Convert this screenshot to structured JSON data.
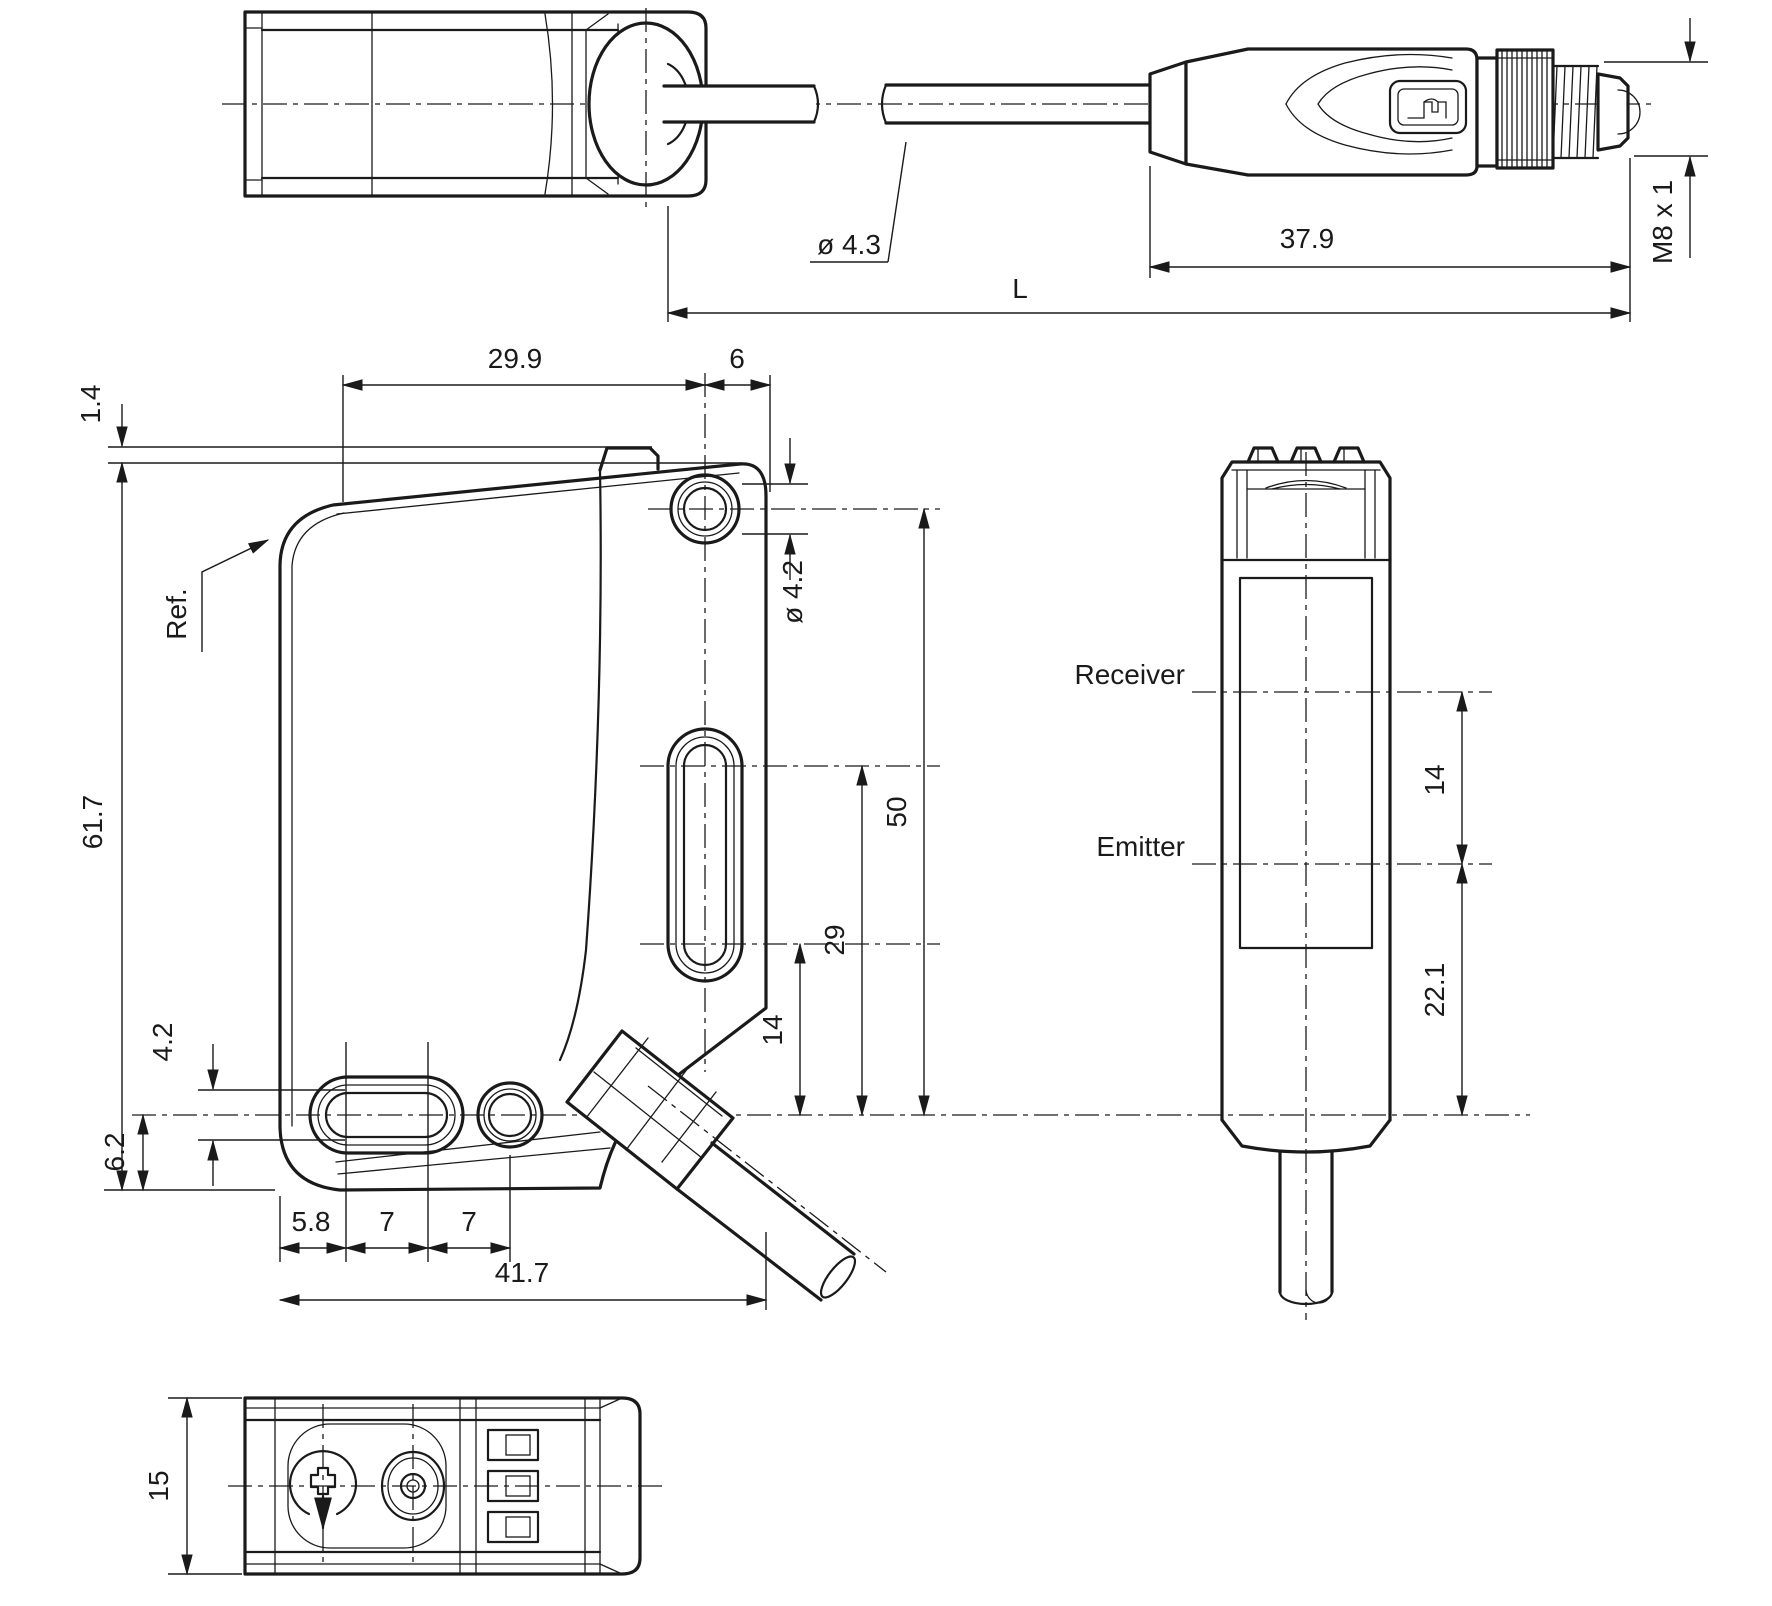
{
  "drawing": {
    "line_color": "#1a1a1a",
    "background": "#ffffff",
    "top_view": {
      "cable_diameter": "ø 4.3",
      "connector_length": "37.9",
      "thread_spec": "M8 x 1",
      "total_length": "L"
    },
    "front_view": {
      "tab_height": "1.4",
      "top_hole_offset": "29.9",
      "hole_edge_offset": "6",
      "reference_label": "Ref.",
      "hole_diameter": "ø 4.2",
      "total_height": "61.7",
      "hole_height_50": "50",
      "slot_top_height": "29",
      "slot_bottom_height": "14",
      "slot_width": "4.2",
      "axis_bottom_offset": "6.2",
      "chain_left": "5.8",
      "chain_mid": "7",
      "chain_right": "7",
      "total_width": "41.7"
    },
    "side_view": {
      "receiver_label": "Receiver",
      "emitter_label": "Emitter",
      "optic_spacing": "14",
      "emitter_bottom": "22.1"
    },
    "bottom_view": {
      "depth": "15"
    }
  }
}
